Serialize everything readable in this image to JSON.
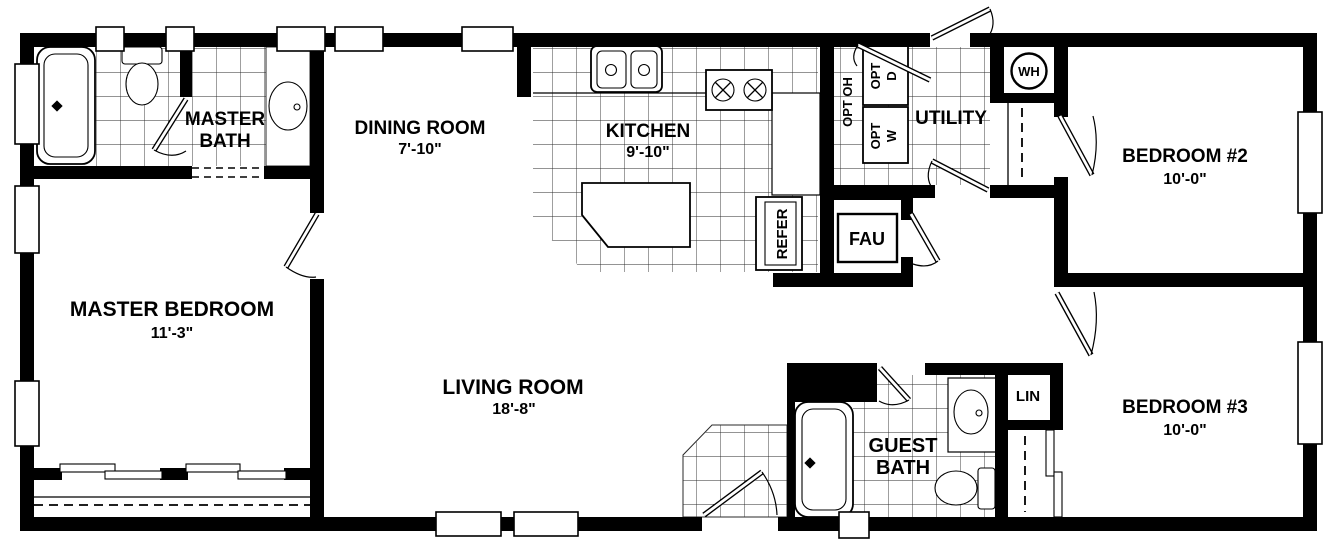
{
  "plan": {
    "title": "Mobile home floor plan",
    "rooms": {
      "master_bath": {
        "name_line1": "MASTER",
        "name_line2": "BATH"
      },
      "dining_room": {
        "name": "DINING ROOM",
        "dimension": "7'-10\""
      },
      "kitchen": {
        "name": "KITCHEN",
        "dimension": "9'-10\""
      },
      "utility": {
        "name": "UTILITY"
      },
      "master_bedroom": {
        "name": "MASTER BEDROOM",
        "dimension": "11'-3\""
      },
      "living_room": {
        "name": "LIVING ROOM",
        "dimension": "18'-8\""
      },
      "bedroom2": {
        "name": "BEDROOM #2",
        "dimension": "10'-0\""
      },
      "bedroom3": {
        "name": "BEDROOM #3",
        "dimension": "10'-0\""
      },
      "guest_bath": {
        "name_line1": "GUEST",
        "name_line2": "BATH"
      }
    },
    "features": {
      "water_heater": "WH",
      "furnace": "FAU",
      "refrigerator": "REFER",
      "linen_closet": "LIN",
      "opt_overhead": "OPT OH",
      "opt_dryer_line1": "OPT",
      "opt_dryer_line2": "D",
      "opt_washer_line1": "OPT",
      "opt_washer_line2": "W"
    },
    "colors": {
      "wall": "#000000",
      "background": "#ffffff",
      "tile_line": "#2a2a2a"
    }
  }
}
